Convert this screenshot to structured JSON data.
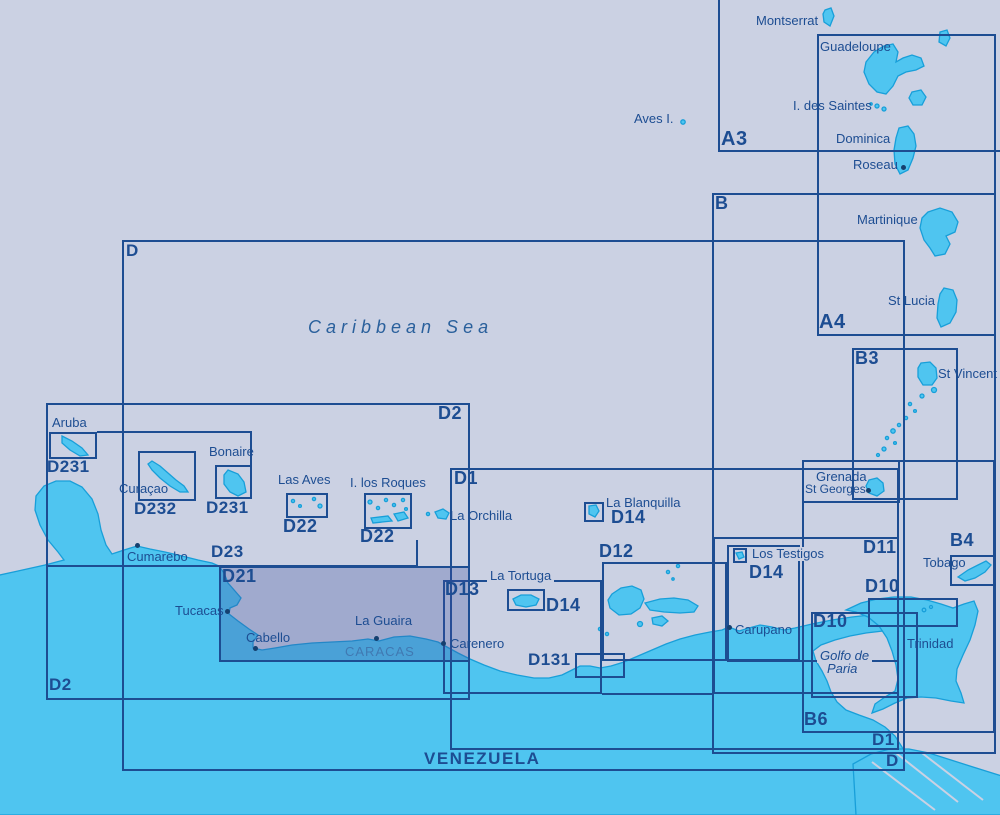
{
  "colors": {
    "sea": "#cbd1e3",
    "land": "#4fc5f0",
    "land_outline": "#189fd9",
    "line": "#1d4d92",
    "text": "#1d4d92",
    "highlight": "rgba(62,78,158,0.30)",
    "caracas_text": "#4079b2"
  },
  "sea_label": "Caribbean Sea",
  "country_label": "VENEZUELA",
  "charts": {
    "a3": "A3",
    "a4": "A4",
    "b": "B",
    "b3": "B3",
    "b4": "B4",
    "b6": "B6",
    "d": "D",
    "d1": "D1",
    "d2": "D2",
    "d10": "D10",
    "d11": "D11",
    "d12": "D12",
    "d13": "D13",
    "d131": "D131",
    "d14": "D14",
    "d21": "D21",
    "d22": "D22",
    "d23": "D23",
    "d231": "D231",
    "d232": "D232"
  },
  "places": {
    "montserrat": "Montserrat",
    "guadeloupe": "Guadeloupe",
    "i_des_saintes": "I. des Saintes",
    "dominica": "Dominica",
    "roseau": "Roseau",
    "martinique": "Martinique",
    "st_lucia": "St Lucia",
    "st_vincent": "St Vincent",
    "grenada": "Grenada",
    "st_georges": "St Georges",
    "tobago": "Tobago",
    "trinidad": "Trinidad",
    "golfo_de_paria_1": "Golfo de",
    "golfo_de_paria_2": "Paria",
    "carupano": "Carupano",
    "carenero": "Carenero",
    "cumarebo": "Cumarebo",
    "tucacas": "Tucacas",
    "cabello": "Cabello",
    "la_guaira": "La Guaira",
    "caracas": "CARACAS",
    "la_orchilla": "La Orchilla",
    "la_blanquilla": "La Blanquilla",
    "la_tortuga": "La Tortuga",
    "los_testigos": "Los Testigos",
    "las_aves": "Las Aves",
    "i_los_roques": "I. los Roques",
    "aves_i": "Aves I.",
    "aruba": "Aruba",
    "curacao": "Curaçao",
    "bonaire": "Bonaire"
  },
  "selected_chart": "D21"
}
